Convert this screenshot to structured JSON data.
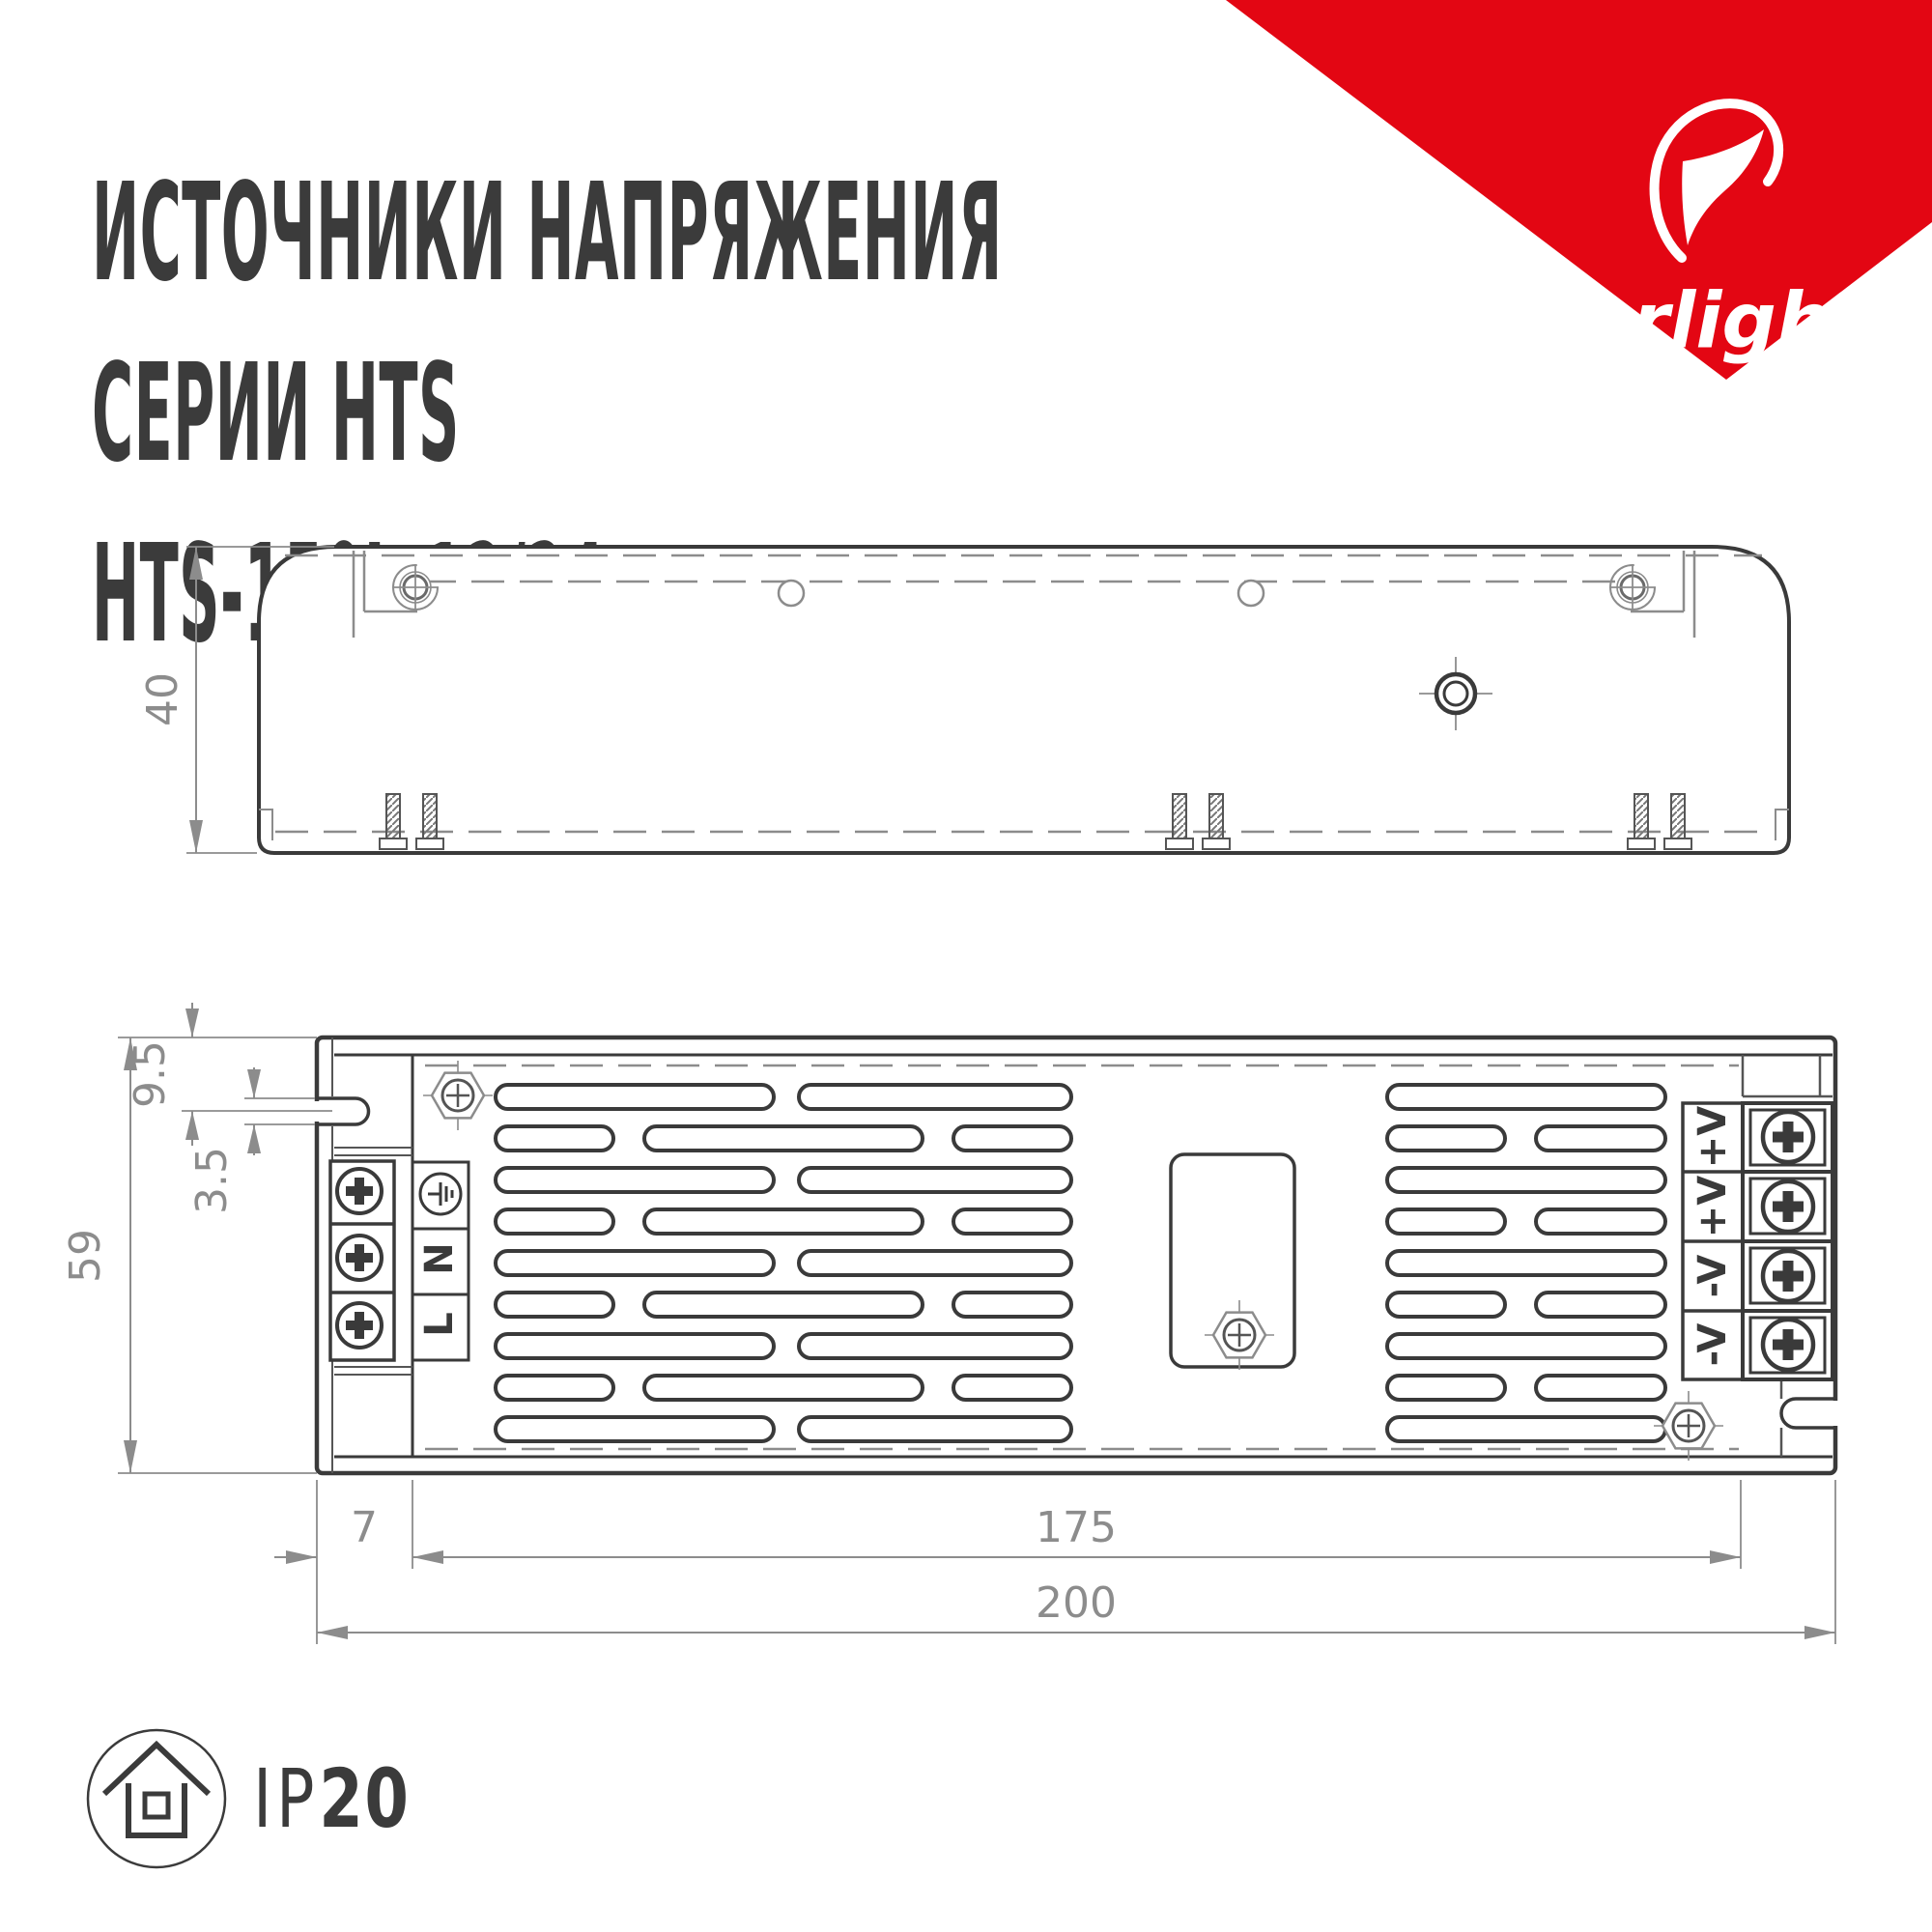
{
  "header": {
    "title_line1": "ИСТОЧНИКИ НАПРЯЖЕНИЯ",
    "title_line2": "СЕРИИ HTS",
    "title_line3": "HTS-150L-12/24"
  },
  "brand": {
    "name": "arlight",
    "registered": "®",
    "accent_color": "#E30613"
  },
  "drawings": {
    "side_view": {
      "height_dim": "40"
    },
    "top_view": {
      "height_dim": "59",
      "slot_offset_dim": "9.5",
      "slot_width_dim": "3.5",
      "flange_dim": "7",
      "mount_dim": "175",
      "length_dim": "200",
      "input_terminal_2": "N",
      "input_terminal_3": "L",
      "output_terminal_1": "+V",
      "output_terminal_2": "+V",
      "output_terminal_3": "-V",
      "output_terminal_4": "-V"
    }
  },
  "footer": {
    "ip_prefix": "IP",
    "ip_value": "20"
  }
}
